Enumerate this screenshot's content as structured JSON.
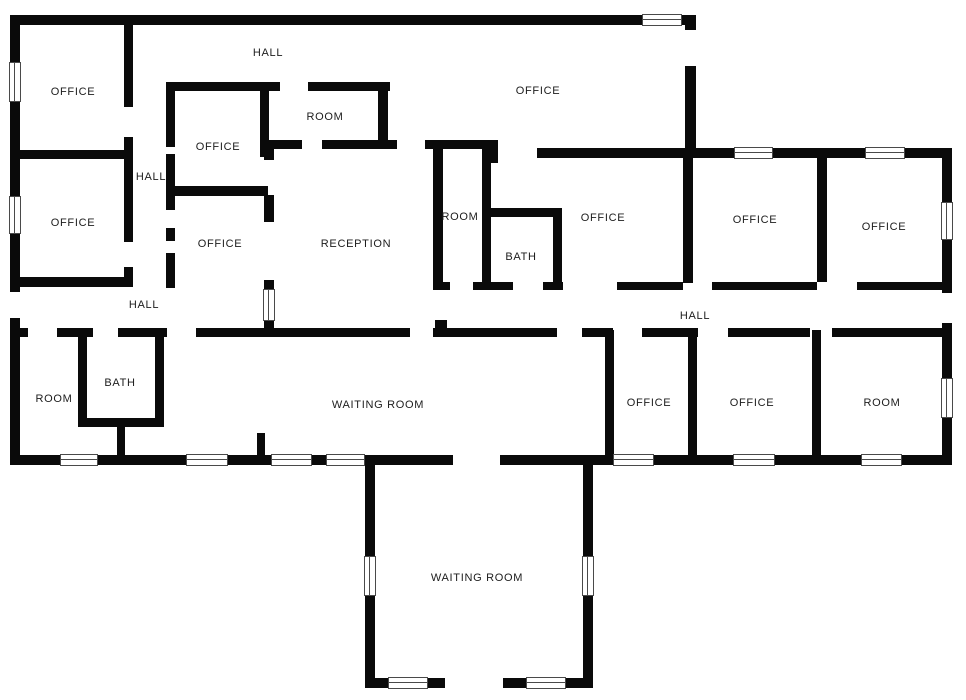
{
  "colors": {
    "wall": "#0a0a0a",
    "background": "#ffffff",
    "window_border": "#4a4a4a",
    "label_text": "#1c1c1c"
  },
  "canvas": {
    "width": 966,
    "height": 700
  },
  "rooms": [
    {
      "label": "HALL",
      "x": 268,
      "y": 53
    },
    {
      "label": "OFFICE",
      "x": 73,
      "y": 92
    },
    {
      "label": "OFFICE",
      "x": 73,
      "y": 223
    },
    {
      "label": "HALL",
      "x": 151,
      "y": 177
    },
    {
      "label": "OFFICE",
      "x": 218,
      "y": 147
    },
    {
      "label": "OFFICE",
      "x": 220,
      "y": 244
    },
    {
      "label": "ROOM",
      "x": 325,
      "y": 117
    },
    {
      "label": "OFFICE",
      "x": 538,
      "y": 91
    },
    {
      "label": "RECEPTION",
      "x": 356,
      "y": 244
    },
    {
      "label": "ROOM",
      "x": 460,
      "y": 217
    },
    {
      "label": "BATH",
      "x": 521,
      "y": 257
    },
    {
      "label": "OFFICE",
      "x": 603,
      "y": 218
    },
    {
      "label": "OFFICE",
      "x": 755,
      "y": 220
    },
    {
      "label": "OFFICE",
      "x": 884,
      "y": 227
    },
    {
      "label": "HALL",
      "x": 144,
      "y": 305
    },
    {
      "label": "HALL",
      "x": 695,
      "y": 316
    },
    {
      "label": "ROOM",
      "x": 54,
      "y": 399
    },
    {
      "label": "BATH",
      "x": 120,
      "y": 383
    },
    {
      "label": "WAITING ROOM",
      "x": 378,
      "y": 405
    },
    {
      "label": "OFFICE",
      "x": 649,
      "y": 403
    },
    {
      "label": "OFFICE",
      "x": 752,
      "y": 403
    },
    {
      "label": "ROOM",
      "x": 882,
      "y": 403
    },
    {
      "label": "WAITING ROOM",
      "x": 477,
      "y": 578
    }
  ],
  "walls": [
    [
      10,
      15,
      686,
      10
    ],
    [
      10,
      15,
      10,
      277
    ],
    [
      10,
      318,
      10,
      147
    ],
    [
      685,
      15,
      11,
      15
    ],
    [
      685,
      66,
      11,
      92
    ],
    [
      685,
      148,
      267,
      10
    ],
    [
      942,
      148,
      10,
      145
    ],
    [
      942,
      323,
      10,
      142
    ],
    [
      10,
      455,
      355,
      10
    ],
    [
      365,
      455,
      88,
      10
    ],
    [
      500,
      455,
      93,
      10
    ],
    [
      593,
      455,
      359,
      10
    ],
    [
      365,
      455,
      10,
      233
    ],
    [
      583,
      455,
      10,
      233
    ],
    [
      365,
      678,
      80,
      10
    ],
    [
      503,
      678,
      90,
      10
    ],
    [
      10,
      150,
      122,
      9
    ],
    [
      124,
      15,
      9,
      92
    ],
    [
      124,
      137,
      9,
      21
    ],
    [
      124,
      158,
      9,
      84
    ],
    [
      124,
      267,
      9,
      20
    ],
    [
      10,
      277,
      123,
      10
    ],
    [
      166,
      82,
      114,
      9
    ],
    [
      308,
      82,
      82,
      9
    ],
    [
      166,
      82,
      9,
      65
    ],
    [
      166,
      154,
      9,
      56
    ],
    [
      166,
      228,
      9,
      13
    ],
    [
      166,
      253,
      9,
      35
    ],
    [
      166,
      186,
      102,
      10
    ],
    [
      260,
      82,
      9,
      58
    ],
    [
      260,
      140,
      14,
      17
    ],
    [
      264,
      140,
      10,
      20
    ],
    [
      264,
      195,
      10,
      27
    ],
    [
      264,
      280,
      10,
      50
    ],
    [
      378,
      82,
      10,
      58
    ],
    [
      266,
      140,
      36,
      9
    ],
    [
      322,
      140,
      75,
      9
    ],
    [
      425,
      140,
      73,
      9
    ],
    [
      483,
      140,
      15,
      23
    ],
    [
      537,
      148,
      156,
      10
    ],
    [
      433,
      140,
      10,
      150
    ],
    [
      435,
      320,
      12,
      12
    ],
    [
      482,
      142,
      9,
      148
    ],
    [
      482,
      208,
      80,
      9
    ],
    [
      553,
      208,
      9,
      82
    ],
    [
      433,
      282,
      17,
      8
    ],
    [
      473,
      282,
      40,
      8
    ],
    [
      543,
      282,
      20,
      8
    ],
    [
      617,
      282,
      66,
      8
    ],
    [
      683,
      148,
      10,
      135
    ],
    [
      712,
      282,
      105,
      8
    ],
    [
      817,
      158,
      10,
      124
    ],
    [
      857,
      282,
      85,
      8
    ],
    [
      10,
      328,
      18,
      9
    ],
    [
      57,
      328,
      36,
      9
    ],
    [
      118,
      328,
      49,
      9
    ],
    [
      196,
      328,
      214,
      9
    ],
    [
      433,
      328,
      124,
      9
    ],
    [
      582,
      328,
      31,
      9
    ],
    [
      642,
      328,
      56,
      9
    ],
    [
      728,
      328,
      82,
      9
    ],
    [
      832,
      328,
      116,
      9
    ],
    [
      605,
      330,
      9,
      126
    ],
    [
      688,
      330,
      9,
      126
    ],
    [
      812,
      330,
      9,
      126
    ],
    [
      78,
      337,
      9,
      90
    ],
    [
      155,
      337,
      9,
      90
    ],
    [
      78,
      418,
      86,
      9
    ],
    [
      117,
      427,
      8,
      29
    ],
    [
      257,
      433,
      8,
      23
    ]
  ],
  "windows": [
    {
      "x": 642,
      "y": 14,
      "w": 40,
      "h": 12,
      "o": "h"
    },
    {
      "x": 9,
      "y": 62,
      "w": 12,
      "h": 40,
      "o": "v"
    },
    {
      "x": 9,
      "y": 196,
      "w": 12,
      "h": 38,
      "o": "v"
    },
    {
      "x": 734,
      "y": 147,
      "w": 39,
      "h": 12,
      "o": "h"
    },
    {
      "x": 865,
      "y": 147,
      "w": 40,
      "h": 12,
      "o": "h"
    },
    {
      "x": 941,
      "y": 202,
      "w": 12,
      "h": 38,
      "o": "v"
    },
    {
      "x": 941,
      "y": 378,
      "w": 12,
      "h": 40,
      "o": "v"
    },
    {
      "x": 263,
      "y": 289,
      "w": 12,
      "h": 32,
      "o": "v"
    },
    {
      "x": 60,
      "y": 454,
      "w": 38,
      "h": 12,
      "o": "h"
    },
    {
      "x": 186,
      "y": 454,
      "w": 42,
      "h": 12,
      "o": "h"
    },
    {
      "x": 271,
      "y": 454,
      "w": 41,
      "h": 12,
      "o": "h"
    },
    {
      "x": 326,
      "y": 454,
      "w": 39,
      "h": 12,
      "o": "h"
    },
    {
      "x": 613,
      "y": 454,
      "w": 41,
      "h": 12,
      "o": "h"
    },
    {
      "x": 733,
      "y": 454,
      "w": 42,
      "h": 12,
      "o": "h"
    },
    {
      "x": 861,
      "y": 454,
      "w": 41,
      "h": 12,
      "o": "h"
    },
    {
      "x": 364,
      "y": 556,
      "w": 12,
      "h": 40,
      "o": "v"
    },
    {
      "x": 582,
      "y": 556,
      "w": 12,
      "h": 40,
      "o": "v"
    },
    {
      "x": 388,
      "y": 677,
      "w": 40,
      "h": 12,
      "o": "h"
    },
    {
      "x": 526,
      "y": 677,
      "w": 40,
      "h": 12,
      "o": "h"
    }
  ]
}
